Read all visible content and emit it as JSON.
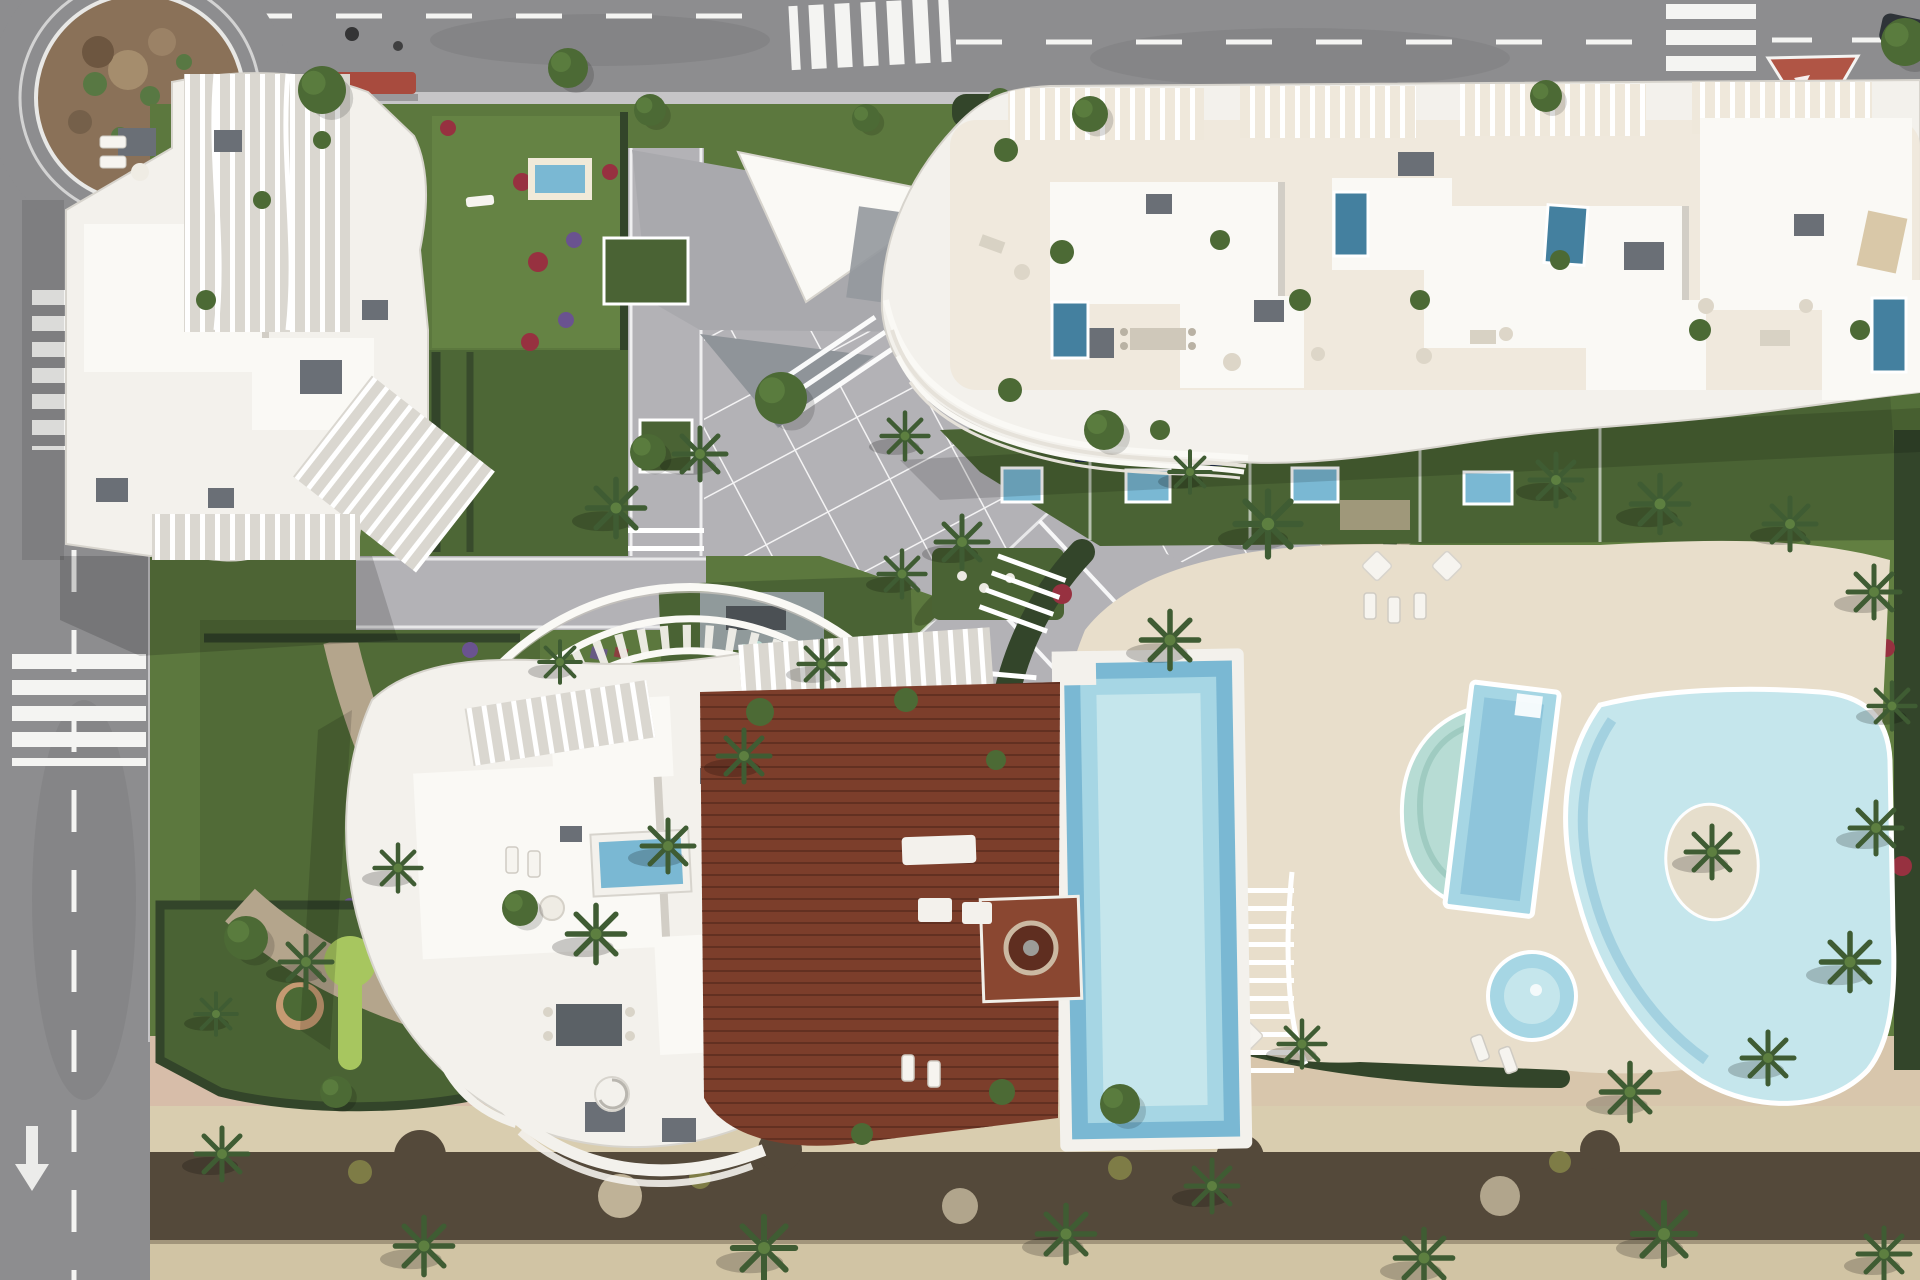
{
  "canvas": {
    "viewBox": "0 0 1920 1280",
    "width": 1920,
    "height": 1280
  },
  "palette": {
    "road": "#8d8d8f",
    "roadDark": "#7e7e81",
    "sidewalk": "#c6c5c7",
    "lawn": "#5c783e",
    "lawnDark": "#4a6334",
    "lawnLight": "#6e8c49",
    "puttingGreen": "#a7c65f",
    "hedge": "#33452a",
    "scrub": "#54493a",
    "gravel": "#b4a58c",
    "flowerRed": "#973140",
    "flowerPurple": "#6a5390",
    "paving": "#b3b2b6",
    "deckStone": "#e8decb",
    "sand": "#d9cdaf",
    "sandShade": "#cdbf9e",
    "pinkPath": "#d7bda9",
    "bldgWhite": "#f3f1ec",
    "roofWhite": "#faf9f5",
    "cream": "#efe8db",
    "bldgEdge": "#d7d4cd",
    "finBand": "#dad7d0",
    "pergola": "#98a0a6",
    "grayBox": "#6a6f76",
    "wood": "#7c3e2b",
    "woodLine": "#5c2d1f",
    "poolPale": "#c5e6ec",
    "poolLight": "#a6d6e4",
    "poolMid": "#7ab8d3",
    "poolDeep": "#44809f",
    "poolTeal": "#b7dcd4",
    "rock": "#8a7158",
    "cactus": "#587843",
    "tree": "#4c6a35",
    "treeLight": "#5d7f40",
    "palm": "#3f5c33",
    "vanWhite": "#f2f2f2",
    "redRoof": "#a84b3e",
    "islandRed": "#b05545"
  },
  "scene": {
    "type": "aerial-architectural-render",
    "features": [
      "roundabout with rocky cactus island",
      "top road with zebra crossings, dashed lanes, white van and red traffic island",
      "left road with crosswalks and lane arrow",
      "north-west apartment building with curved white balcony fins",
      "north-east apartment building with rooftop terraces and plunge pools",
      "central building with fan pergola, wooden deck, fire pit and private pool",
      "communal pool area: half-moon pool, lap pool, free-form lagoon pool with palm island, round kids pool",
      "central paved plaza with rotated grid paving",
      "diagonal pedestrian boulevard with palm shadows",
      "mini-golf putting greens",
      "gardens with lawns, hedges, red and purple flower beds",
      "beach promenade with sand band, dark scrub strip and palm trees"
    ]
  }
}
